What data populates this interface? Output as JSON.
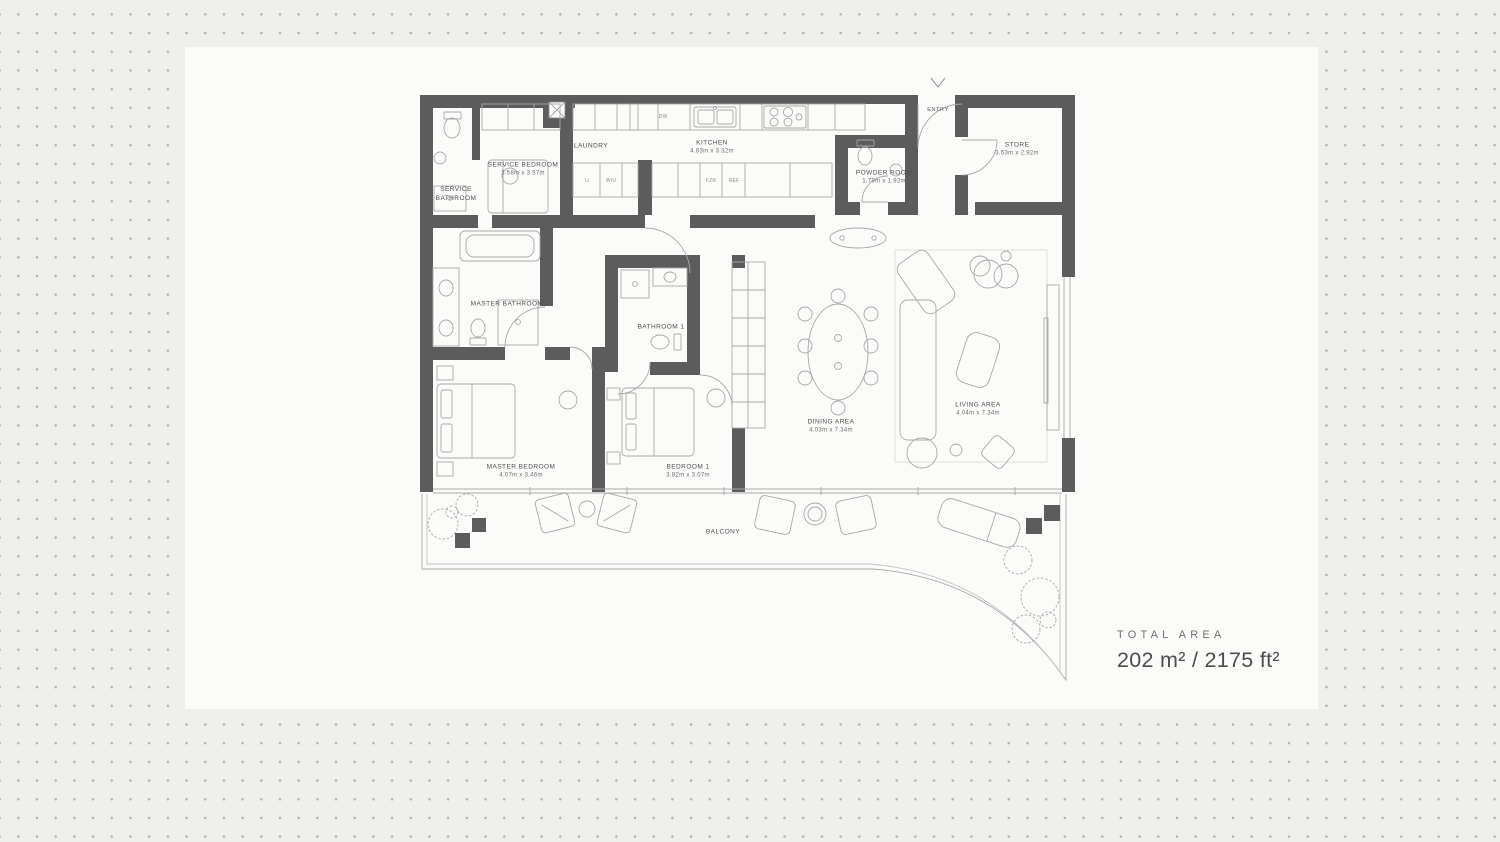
{
  "total_area": {
    "label": "TOTAL AREA",
    "value": "202 m² / 2175 ft²"
  },
  "entry": {
    "label": "ENTRY"
  },
  "rooms": [
    {
      "name": "SERVICE BATHROOM",
      "dims": ""
    },
    {
      "name": "SERVICE BEDROOM",
      "dims": "3.58m x 3.57m"
    },
    {
      "name": "LAUNDRY",
      "dims": ""
    },
    {
      "name": "KITCHEN",
      "dims": "4.83m x 3.32m"
    },
    {
      "name": "POWDER ROOM",
      "dims": "1.79m x 1.92m"
    },
    {
      "name": "STORE",
      "dims": "3.53m x 2.92m"
    },
    {
      "name": "MASTER BATHROOM",
      "dims": ""
    },
    {
      "name": "BATHROOM 1",
      "dims": ""
    },
    {
      "name": "MASTER BEDROOM",
      "dims": "4.07m x 3.46m"
    },
    {
      "name": "BEDROOM 1",
      "dims": "3.82m x 3.07m"
    },
    {
      "name": "DINING AREA",
      "dims": "4.03m x 7.34m"
    },
    {
      "name": "LIVING AREA",
      "dims": "4.04m x 7.34m"
    },
    {
      "name": "BALCONY",
      "dims": ""
    }
  ],
  "appliances": {
    "dw": "DW",
    "u": "U",
    "wu": "W/U",
    "fzr": "FZR",
    "ref": "REF"
  },
  "colors": {
    "wall": "#5c5c5c",
    "line": "#a8a8a8",
    "dots": "#b2b2b0",
    "panel": "#fbfbfa"
  }
}
